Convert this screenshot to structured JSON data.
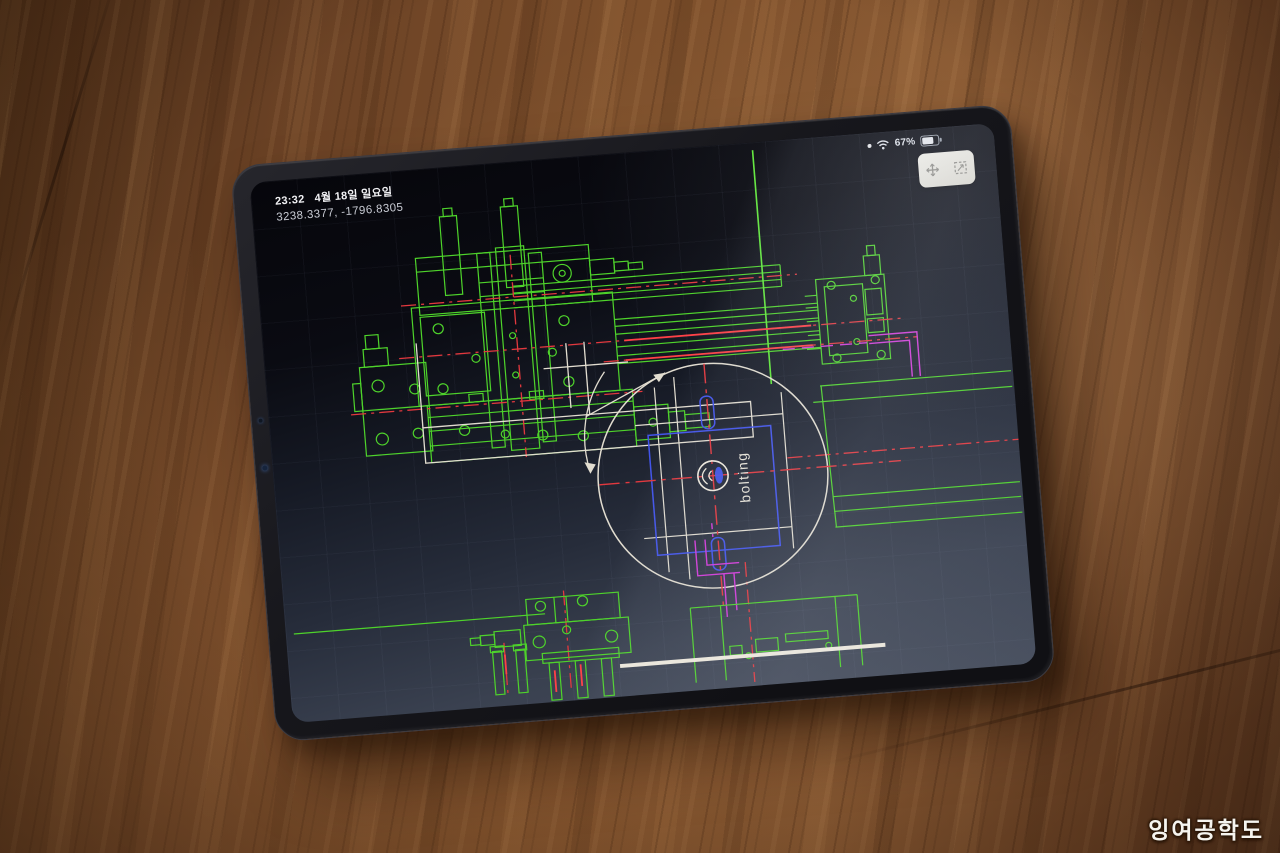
{
  "watermark": {
    "text": "잉여공학도"
  },
  "tablet": {
    "status_bar": {
      "time": "23:32",
      "date": "4월 18일 일요일",
      "battery_percent": "67%",
      "icons": [
        "indicator-dot",
        "wifi-icon",
        "battery-icon"
      ]
    },
    "cad_app": {
      "cursor_coordinates": "3238.3377, -1796.8305",
      "annotation_label": "bolting",
      "floating_toolbar_icons": [
        "pan-icon",
        "zoom-window-icon"
      ],
      "colors": {
        "line_green": "#4ed32b",
        "centerline_red": "#e2383e",
        "line_white": "#e2ddd0",
        "line_magenta": "#d13ad8",
        "line_blue": "#4254ea",
        "screen_background": "#0a0b12"
      }
    }
  }
}
